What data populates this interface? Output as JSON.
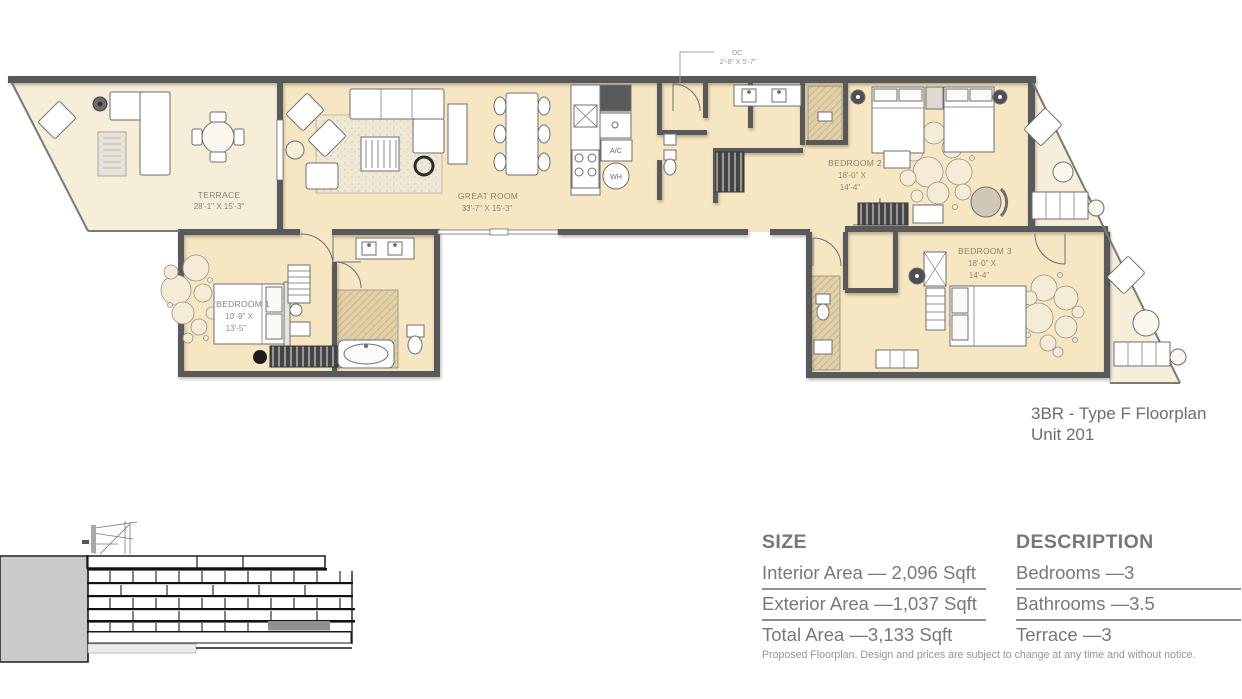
{
  "floorplan": {
    "title": {
      "line1": "3BR - Type F Floorplan",
      "line2": "Unit 201"
    },
    "closet_callout": {
      "line1": "OC",
      "line2": "2'-8\" X 5'-7\""
    },
    "rooms": {
      "terrace": {
        "name": "TERRACE",
        "dims": "28'-1\" X 15'-3\""
      },
      "great_room": {
        "name": "GREAT ROOM",
        "dims": "33'-7\" X 15'-3\""
      },
      "bedroom1": {
        "name": "BEDROOM 1",
        "dims1": "10'-9\" X",
        "dims2": "13'-5\""
      },
      "bedroom2": {
        "name": "BEDROOM 2",
        "dims1": "18'-0\" X",
        "dims2": "14'-4\""
      },
      "bedroom3": {
        "name": "BEDROOM 3",
        "dims1": "18'-0\" X",
        "dims2": "14'-4\""
      }
    },
    "utilities": {
      "ac": "A/C",
      "wh": "WH"
    }
  },
  "info_panel": {
    "size": {
      "header": "SIZE",
      "rows": [
        "Interior Area — 2,096 Sqft",
        "Exterior Area —1,037 Sqft",
        "Total Area —3,133 Sqft"
      ]
    },
    "description": {
      "header": "DESCRIPTION",
      "rows": [
        "Bedrooms —3",
        "Bathrooms —3.5",
        "Terrace —3"
      ]
    },
    "disclaimer": "Proposed Floorplan. Design and prices are subject to change at any time and without notice."
  },
  "colors": {
    "interior_fill": "#f7e6c2",
    "terrace_fill": "#f6eed8",
    "wall": "#58595b",
    "hatch_floor": "#e2d0a8",
    "text_gray": "#77787b",
    "highlight_unit": "#909090"
  }
}
